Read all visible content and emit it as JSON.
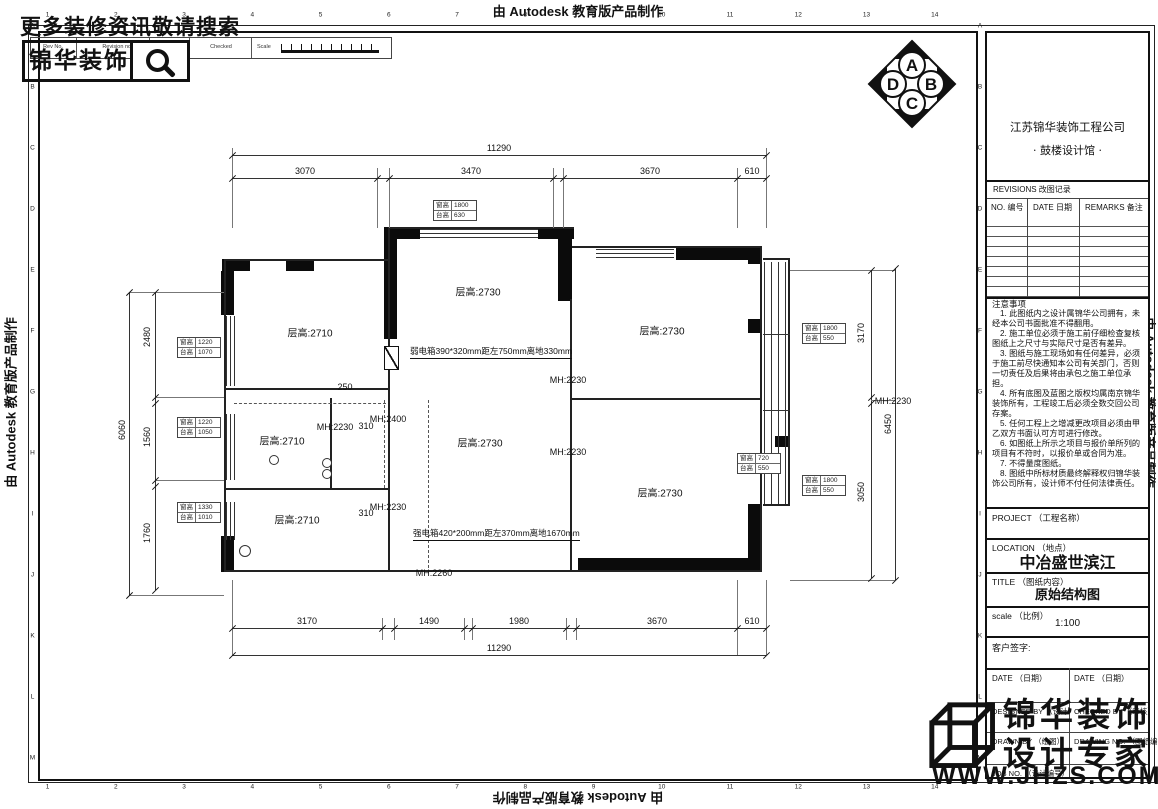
{
  "banner": {
    "text": "由 Autodesk 教育版产品制作"
  },
  "promo": {
    "search_text": "更多装修资讯敬请搜索",
    "brand": "锦华装饰"
  },
  "rev_strip": {
    "rev_no": "Rev No.",
    "revision_note": "Revision note",
    "signature": "Signature",
    "checked": "Checked",
    "scale": "Scale"
  },
  "compass": {
    "n": "A",
    "e": "B",
    "s": "C",
    "w": "D"
  },
  "grid": {
    "cols": [
      "1",
      "2",
      "3",
      "4",
      "5",
      "6",
      "7",
      "8",
      "9",
      "10",
      "11",
      "12",
      "13",
      "14"
    ],
    "rows": [
      "A",
      "B",
      "C",
      "D",
      "E",
      "F",
      "G",
      "H",
      "I",
      "J",
      "K",
      "L",
      "M"
    ]
  },
  "titleblock": {
    "company": "江苏锦华装饰工程公司",
    "studio": "· 鼓楼设计馆 ·",
    "revisions_header": "REVISIONS 改图记录",
    "rev_cols": [
      "NO. 编号",
      "DATE 日期",
      "REMARKS 备注"
    ],
    "notes_title": "注意事项",
    "notes": [
      "1. 此图纸内之设计属锦华公司拥有，未经本公司书面批准不得翻用。",
      "2. 施工单位必须于施工前仔细检查复核图纸上之尺寸与实际尺寸是否有差异。",
      "3. 图纸与施工现场如有任何差异，必须于施工前尽快通知本公司有关部门，否则一切责任及后果将由承包之施工单位承担。",
      "4. 所有底图及蓝图之版权均属南京锦华装饰所有，工程竣工后必须全数交回公司存案。",
      "5. 任何工程上之增减更改项目必须由甲乙双方书面认可方可进行修改。",
      "6. 如图纸上所示之项目与报价单所列的项目有不符时，以报价单或合同为准。",
      "7. 不得量度图纸。",
      "8. 图纸中所标材质最终解释权归锦华装饰公司所有，设计师不付任何法律责任。"
    ],
    "project_label": "PROJECT （工程名称）",
    "location_label": "LOCATION （地点）",
    "location_value": "中冶盛世滨江",
    "title_label": "TITLE （图纸内容）",
    "title_value": "原始结构图",
    "scale_label": "scale （比例）",
    "scale_value": "1:100",
    "client_sign_label": "客户签字:",
    "date_label_1": "DATE （日期）",
    "date_label_2": "DATE （日期）",
    "designed_label": "DESIGNED BY （设计）",
    "checked_label": "CHECKED BY （审核）",
    "drawn_label": "DRAWN BY （绘图）",
    "drawing_no_label": "DRAWING NO. （图纸编号）",
    "job_no_label": "JOB NO. （设计编号）",
    "logo_line1": "锦华装饰",
    "logo_line2": "设计专家",
    "website": "WWW.JHZS.COM"
  },
  "plan": {
    "dims": [
      [
        "11290",
        499,
        148,
        0
      ],
      [
        "3070",
        305,
        171,
        0
      ],
      [
        "3470",
        471,
        171,
        0
      ],
      [
        "3670",
        650,
        171,
        0
      ],
      [
        "610",
        752,
        171,
        0
      ],
      [
        "3170",
        307,
        621,
        0
      ],
      [
        "1490",
        429,
        621,
        0
      ],
      [
        "1980",
        519,
        621,
        0
      ],
      [
        "3670",
        657,
        621,
        0
      ],
      [
        "610",
        752,
        621,
        0
      ],
      [
        "11290",
        499,
        648,
        0
      ],
      [
        "6060",
        122,
        430,
        1
      ],
      [
        "2480",
        147,
        337,
        1
      ],
      [
        "1560",
        147,
        437,
        1
      ],
      [
        "1760",
        147,
        533,
        1
      ],
      [
        "3170",
        861,
        333,
        1
      ],
      [
        "6450",
        888,
        424,
        1
      ],
      [
        "3050",
        861,
        492,
        1
      ],
      [
        "250",
        345,
        387,
        0
      ],
      [
        "310",
        366,
        426,
        0
      ],
      [
        "310",
        366,
        513,
        0
      ]
    ],
    "rooms": [
      [
        "层高:2710",
        310,
        332
      ],
      [
        "层高:2730",
        478,
        291
      ],
      [
        "层高:2730",
        662,
        330
      ],
      [
        "层高:2710",
        282,
        440
      ],
      [
        "层高:2730",
        480,
        442
      ],
      [
        "层高:2710",
        297,
        519
      ],
      [
        "层高:2730",
        660,
        492
      ]
    ],
    "mh": [
      [
        "MH:2230",
        335,
        427
      ],
      [
        "MH:2400",
        388,
        419
      ],
      [
        "MH:2230",
        388,
        507
      ],
      [
        "MH:2230",
        568,
        380
      ],
      [
        "MH:2230",
        568,
        452
      ],
      [
        "MH:2260",
        434,
        573
      ],
      [
        "MH:2230",
        893,
        401
      ]
    ],
    "equip": [
      [
        "弱电箱390*320mm距左750mm离地330mm",
        410,
        352
      ],
      [
        "强电箱420*200mm距左370mm离地1670mm",
        413,
        534
      ]
    ],
    "tag_labels": [
      "窗高",
      "台高"
    ],
    "tags": [
      [
        433,
        200,
        "1800",
        "630"
      ],
      [
        177,
        337,
        "1220",
        "1070"
      ],
      [
        177,
        417,
        "1220",
        "1050"
      ],
      [
        177,
        502,
        "1330",
        "1010"
      ],
      [
        802,
        323,
        "1800",
        "550"
      ],
      [
        737,
        453,
        "720",
        "550"
      ],
      [
        802,
        475,
        "1800",
        "550"
      ]
    ],
    "geometry": {
      "solid": [
        [
          384,
          227,
          36,
          12
        ],
        [
          538,
          227,
          36,
          12
        ],
        [
          222,
          259,
          28,
          12
        ],
        [
          286,
          259,
          28,
          12
        ],
        [
          384,
          239,
          13,
          100
        ],
        [
          558,
          239,
          14,
          62
        ],
        [
          676,
          246,
          76,
          14
        ],
        [
          748,
          246,
          14,
          18
        ],
        [
          221,
          271,
          13,
          44
        ],
        [
          221,
          536,
          13,
          36
        ],
        [
          578,
          558,
          177,
          14
        ],
        [
          748,
          504,
          14,
          68
        ],
        [
          775,
          436,
          15,
          11
        ],
        [
          748,
          319,
          14,
          14
        ]
      ],
      "thin": [
        [
          224,
          259,
          166,
          2
        ],
        [
          224,
          259,
          2,
          313
        ],
        [
          390,
          227,
          184,
          2
        ],
        [
          388,
          227,
          2,
          34
        ],
        [
          572,
          246,
          190,
          2
        ],
        [
          760,
          246,
          2,
          326
        ],
        [
          224,
          570,
          538,
          2
        ],
        [
          224,
          388,
          166,
          2
        ],
        [
          388,
          261,
          2,
          311
        ],
        [
          224,
          488,
          166,
          2
        ],
        [
          570,
          299,
          2,
          273
        ],
        [
          570,
          398,
          192,
          2
        ],
        [
          330,
          398,
          2,
          92
        ],
        [
          763,
          258,
          27,
          2
        ],
        [
          788,
          258,
          2,
          248
        ],
        [
          763,
          504,
          27,
          2
        ]
      ],
      "win": [
        [
          420,
          229,
          118,
          1
        ],
        [
          420,
          233,
          118,
          1
        ],
        [
          420,
          237,
          118,
          1
        ],
        [
          226,
          316,
          1,
          70
        ],
        [
          230,
          316,
          1,
          70
        ],
        [
          234,
          316,
          1,
          70
        ],
        [
          226,
          414,
          1,
          66
        ],
        [
          230,
          414,
          1,
          66
        ],
        [
          234,
          414,
          1,
          66
        ],
        [
          226,
          502,
          1,
          38
        ],
        [
          230,
          502,
          1,
          38
        ],
        [
          234,
          502,
          1,
          38
        ],
        [
          596,
          249,
          78,
          1
        ],
        [
          596,
          253,
          78,
          1
        ],
        [
          596,
          257,
          78,
          1
        ],
        [
          764,
          262,
          1,
          242
        ],
        [
          771,
          262,
          1,
          242
        ],
        [
          778,
          262,
          1,
          242
        ],
        [
          785,
          262,
          1,
          242
        ],
        [
          763,
          334,
          27,
          1
        ],
        [
          763,
          410,
          27,
          1
        ]
      ],
      "dim": [
        [
          232,
          155,
          534,
          1
        ],
        [
          232,
          178,
          534,
          1
        ],
        [
          232,
          628,
          534,
          1
        ],
        [
          232,
          655,
          534,
          1
        ],
        [
          129,
          292,
          1,
          303
        ],
        [
          155,
          292,
          1,
          298
        ],
        [
          871,
          270,
          1,
          308
        ],
        [
          895,
          268,
          1,
          312
        ]
      ],
      "ext": [
        [
          232,
          148,
          1,
          80
        ],
        [
          377,
          168,
          1,
          60
        ],
        [
          389,
          168,
          1,
          60
        ],
        [
          553,
          168,
          1,
          60
        ],
        [
          563,
          168,
          1,
          60
        ],
        [
          737,
          168,
          1,
          60
        ],
        [
          766,
          148,
          1,
          80
        ],
        [
          232,
          580,
          1,
          75
        ],
        [
          382,
          618,
          1,
          22
        ],
        [
          394,
          618,
          1,
          22
        ],
        [
          464,
          618,
          1,
          22
        ],
        [
          472,
          618,
          1,
          22
        ],
        [
          566,
          618,
          1,
          22
        ],
        [
          576,
          618,
          1,
          22
        ],
        [
          737,
          580,
          1,
          75
        ],
        [
          766,
          580,
          1,
          75
        ],
        [
          129,
          292,
          95,
          1
        ],
        [
          129,
          595,
          95,
          1
        ],
        [
          155,
          397,
          69,
          1
        ],
        [
          155,
          480,
          69,
          1
        ],
        [
          790,
          270,
          105,
          1
        ],
        [
          790,
          580,
          105,
          1
        ],
        [
          871,
          400,
          24,
          1
        ]
      ],
      "ticks": [
        [
          232,
          155
        ],
        [
          766,
          155
        ],
        [
          232,
          178
        ],
        [
          377,
          178
        ],
        [
          389,
          178
        ],
        [
          553,
          178
        ],
        [
          563,
          178
        ],
        [
          737,
          178
        ],
        [
          766,
          178
        ],
        [
          232,
          628
        ],
        [
          382,
          628
        ],
        [
          394,
          628
        ],
        [
          464,
          628
        ],
        [
          472,
          628
        ],
        [
          566,
          628
        ],
        [
          576,
          628
        ],
        [
          737,
          628
        ],
        [
          766,
          628
        ],
        [
          232,
          655
        ],
        [
          766,
          655
        ],
        [
          129,
          292
        ],
        [
          129,
          595
        ],
        [
          155,
          292
        ],
        [
          155,
          397
        ],
        [
          155,
          403
        ],
        [
          155,
          480
        ],
        [
          155,
          486
        ],
        [
          155,
          590
        ],
        [
          871,
          270
        ],
        [
          871,
          397
        ],
        [
          871,
          403
        ],
        [
          871,
          578
        ],
        [
          895,
          268
        ],
        [
          895,
          580
        ]
      ],
      "dash": [
        [
          428,
          400,
          0,
          168
        ],
        [
          234,
          403,
          152,
          0
        ],
        [
          384,
          400,
          0,
          88
        ]
      ],
      "circles": [
        [
          273,
          459,
          4
        ],
        [
          326,
          462,
          4
        ],
        [
          326,
          473,
          4
        ],
        [
          244,
          550,
          5
        ]
      ],
      "boxes": [
        [
          384,
          346,
          13,
          22
        ]
      ]
    }
  }
}
